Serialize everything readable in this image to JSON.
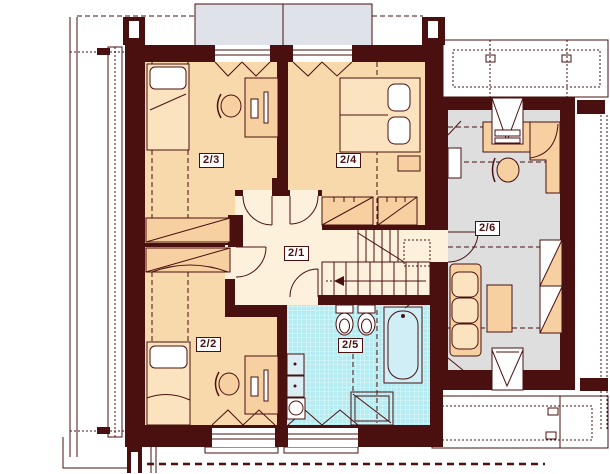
{
  "floor_plan": {
    "room_labels": [
      {
        "label": "2/1"
      },
      {
        "label": "2/2"
      },
      {
        "label": "2/3"
      },
      {
        "label": "2/4"
      },
      {
        "label": "2/5"
      },
      {
        "label": "2/6"
      }
    ]
  },
  "colors": {
    "wall": "#4a1010",
    "bedroom_floor": "#f8d9ab",
    "hall_floor": "#fdf1dc",
    "bathroom_tile": "#b5ecf2",
    "room26_floor": "#dedede",
    "dormer_gray": "#dfe2e8",
    "furniture": "#f6d0a0",
    "furniture_light": "#fbe3c0",
    "fixture_fill": "#daeef5",
    "tub_fill": "#cfeef5"
  }
}
